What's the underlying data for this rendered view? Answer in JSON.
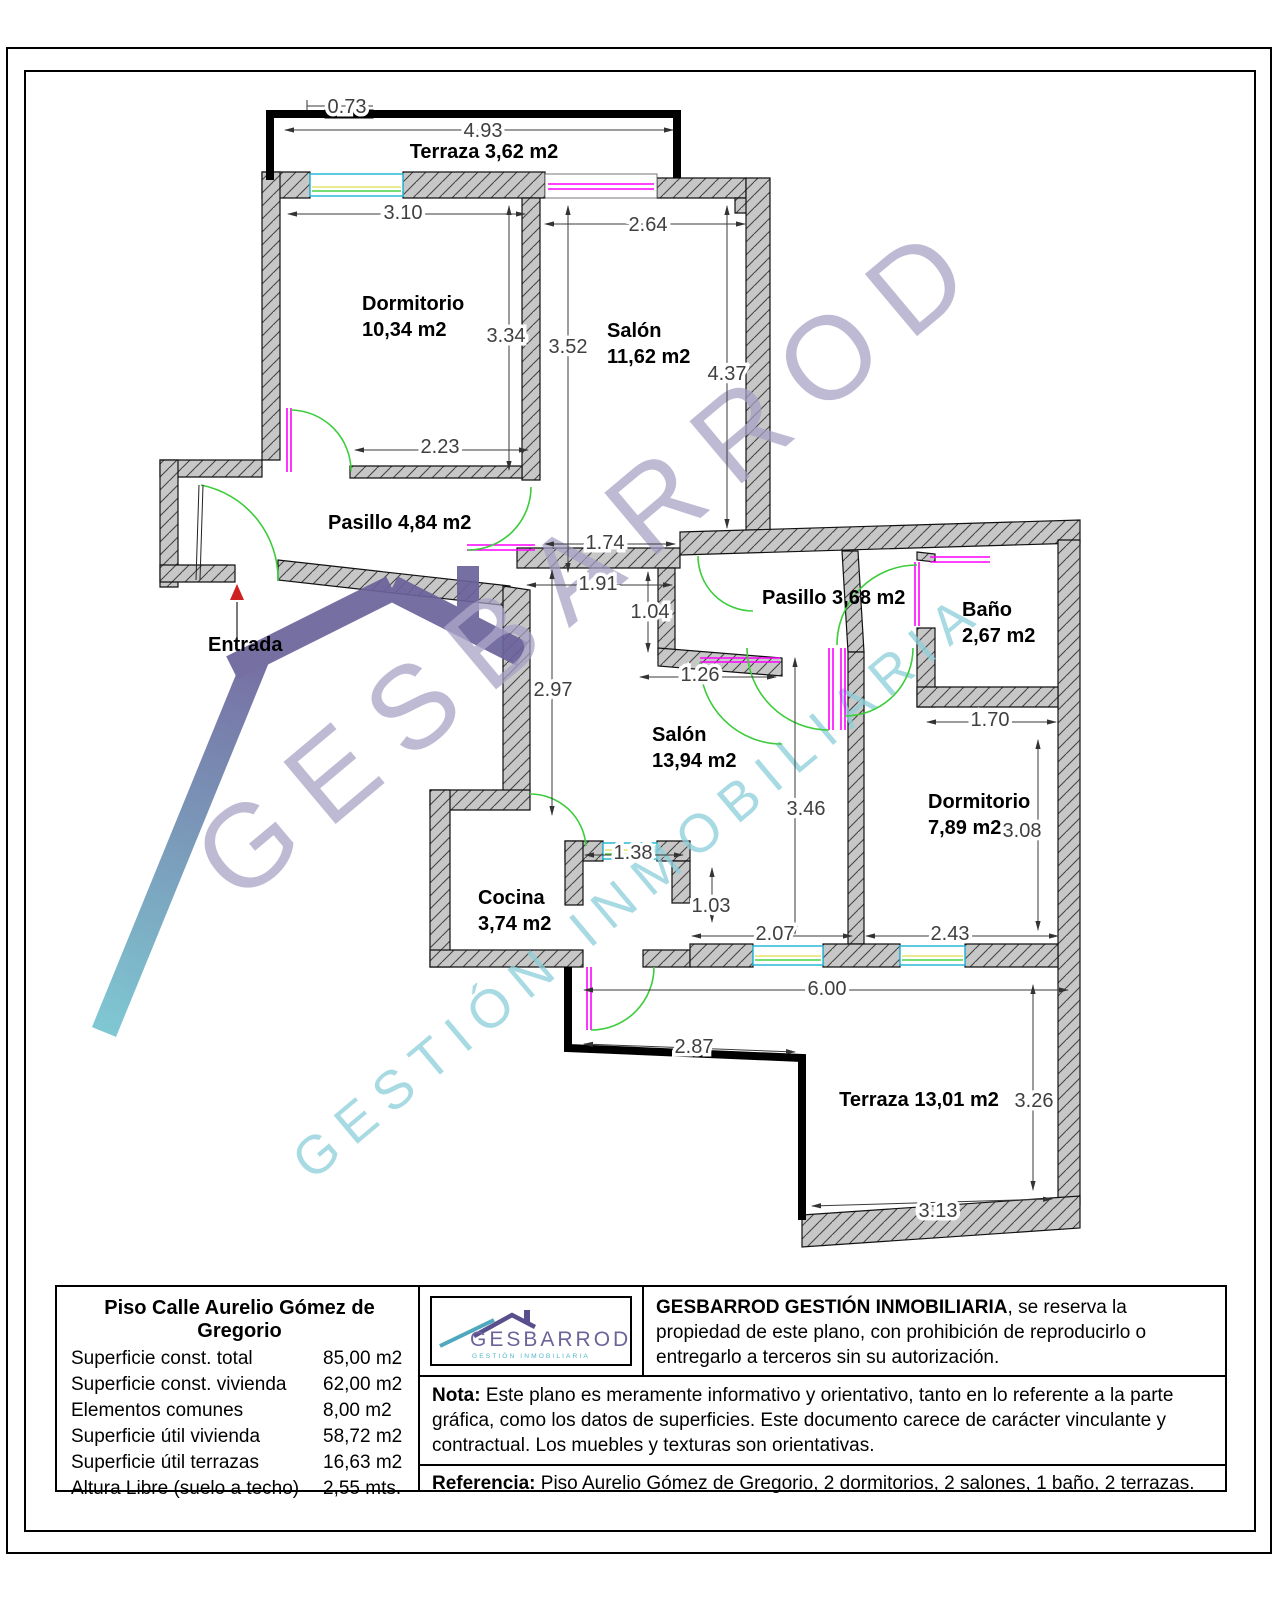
{
  "plan": {
    "rooms": [
      {
        "id": "terraza-superior",
        "lines": [
          "Terraza 3,62 m2"
        ]
      },
      {
        "id": "dormitorio-1",
        "lines": [
          "Dormitorio",
          "10,34 m2"
        ]
      },
      {
        "id": "salon-1",
        "lines": [
          "Salón",
          "11,62 m2"
        ]
      },
      {
        "id": "pasillo-1",
        "lines": [
          "Pasillo 4,84 m2"
        ]
      },
      {
        "id": "entrada",
        "lines": [
          "Entrada"
        ]
      },
      {
        "id": "pasillo-2",
        "lines": [
          "Pasillo 3,68 m2"
        ]
      },
      {
        "id": "bano",
        "lines": [
          "Baño",
          "2,67 m2"
        ]
      },
      {
        "id": "salon-2",
        "lines": [
          "Salón",
          "13,94 m2"
        ]
      },
      {
        "id": "dormitorio-2",
        "lines": [
          "Dormitorio",
          "7,89 m2"
        ]
      },
      {
        "id": "cocina",
        "lines": [
          "Cocina",
          "3,74 m2"
        ]
      },
      {
        "id": "terraza-inferior",
        "lines": [
          "Terraza 13,01 m2"
        ]
      }
    ],
    "dimensions": [
      {
        "id": "d073",
        "value": "0.73"
      },
      {
        "id": "d493",
        "value": "4.93"
      },
      {
        "id": "d310",
        "value": "3.10"
      },
      {
        "id": "d264",
        "value": "2.64"
      },
      {
        "id": "d334",
        "value": "3.34"
      },
      {
        "id": "d352",
        "value": "3.52"
      },
      {
        "id": "d437",
        "value": "4.37"
      },
      {
        "id": "d223",
        "value": "2.23"
      },
      {
        "id": "d174",
        "value": "1.74"
      },
      {
        "id": "d191",
        "value": "1.91"
      },
      {
        "id": "d104",
        "value": "1.04"
      },
      {
        "id": "d297",
        "value": "2.97"
      },
      {
        "id": "d126",
        "value": "1.26"
      },
      {
        "id": "d170",
        "value": "1.70"
      },
      {
        "id": "d346",
        "value": "3.46"
      },
      {
        "id": "d308",
        "value": "3.08"
      },
      {
        "id": "d138",
        "value": "1.38"
      },
      {
        "id": "d103",
        "value": "1.03"
      },
      {
        "id": "d207",
        "value": "2.07"
      },
      {
        "id": "d243",
        "value": "2.43"
      },
      {
        "id": "d600",
        "value": "6.00"
      },
      {
        "id": "d287",
        "value": "2.87"
      },
      {
        "id": "d326",
        "value": "3.26"
      },
      {
        "id": "d313",
        "value": "3.13"
      }
    ]
  },
  "watermark": {
    "line1": "GESBARROD",
    "line2": "GESTIÓN INMOBILIARIA"
  },
  "branding": {
    "logo_name": "GESBARROD",
    "logo_tagline": "GESTIÓN INMOBILIARIA"
  },
  "summary": {
    "title": "Piso Calle Aurelio Gómez de Gregorio",
    "rows": [
      {
        "label": "Superficie const. total",
        "value": "85,00 m2"
      },
      {
        "label": "Superficie const. vivienda",
        "value": "62,00 m2"
      },
      {
        "label": "Elementos comunes",
        "value": "8,00 m2"
      },
      {
        "label": "Superficie útil vivienda",
        "value": "58,72 m2"
      },
      {
        "label": "Superficie útil terrazas",
        "value": "16,63 m2"
      },
      {
        "label": "Altura Libre (suelo a techo)",
        "value": "2,55 mts."
      }
    ]
  },
  "legal": {
    "copyright_bold": "GESBARROD GESTIÓN INMOBILIARIA",
    "copyright_rest": ", se reserva la propiedad de este plano, con prohibición de reproducirlo o entregarlo a terceros sin su autorización.",
    "nota_bold": "Nota:",
    "nota_rest": " Este plano es meramente informativo y orientativo, tanto en lo referente a la parte gráfica, como los datos de superficies. Este documento carece de carácter vinculante y contractual. Los muebles y texturas son orientativas.",
    "referencia_bold": "Referencia:",
    "referencia_rest": " Piso Aurelio Gómez de Gregorio, 2 dormitorios, 2 salones, 1 baño, 2 terrazas."
  }
}
